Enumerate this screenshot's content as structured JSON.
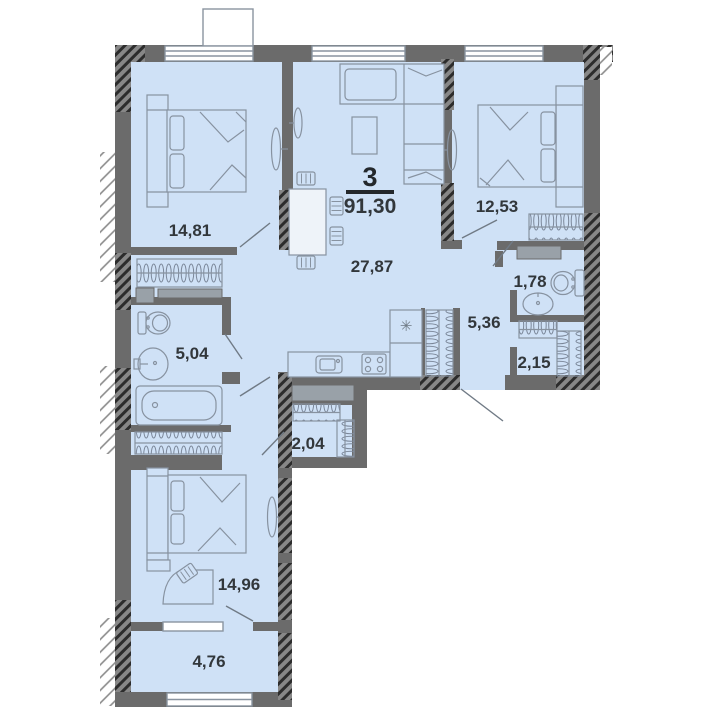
{
  "plan": {
    "title": "apartment-floor-plan",
    "summary": {
      "rooms_count": "3",
      "total_area": "91,30"
    },
    "rooms": [
      {
        "name": "bedroom-top-left",
        "area": "14,81"
      },
      {
        "name": "living-kitchen",
        "area": "27,87"
      },
      {
        "name": "bedroom-top-right",
        "area": "12,53"
      },
      {
        "name": "wc",
        "area": "1,78"
      },
      {
        "name": "hallway",
        "area": "5,36"
      },
      {
        "name": "wardrobe-right",
        "area": "2,15"
      },
      {
        "name": "bathroom",
        "area": "5,04"
      },
      {
        "name": "wardrobe-center",
        "area": "2,04"
      },
      {
        "name": "bedroom-bottom",
        "area": "14,96"
      },
      {
        "name": "balcony",
        "area": "4,76"
      }
    ],
    "icons": {
      "fridge_glyph": "✳"
    },
    "colors": {
      "room_fill": "#cfe1f6",
      "wall": "#6b6b6b",
      "hatch_dark": "#2c2c2c",
      "furniture_line": "#8792a0",
      "label_text": "#32373b",
      "duct_fill": "#99a1a8"
    }
  }
}
